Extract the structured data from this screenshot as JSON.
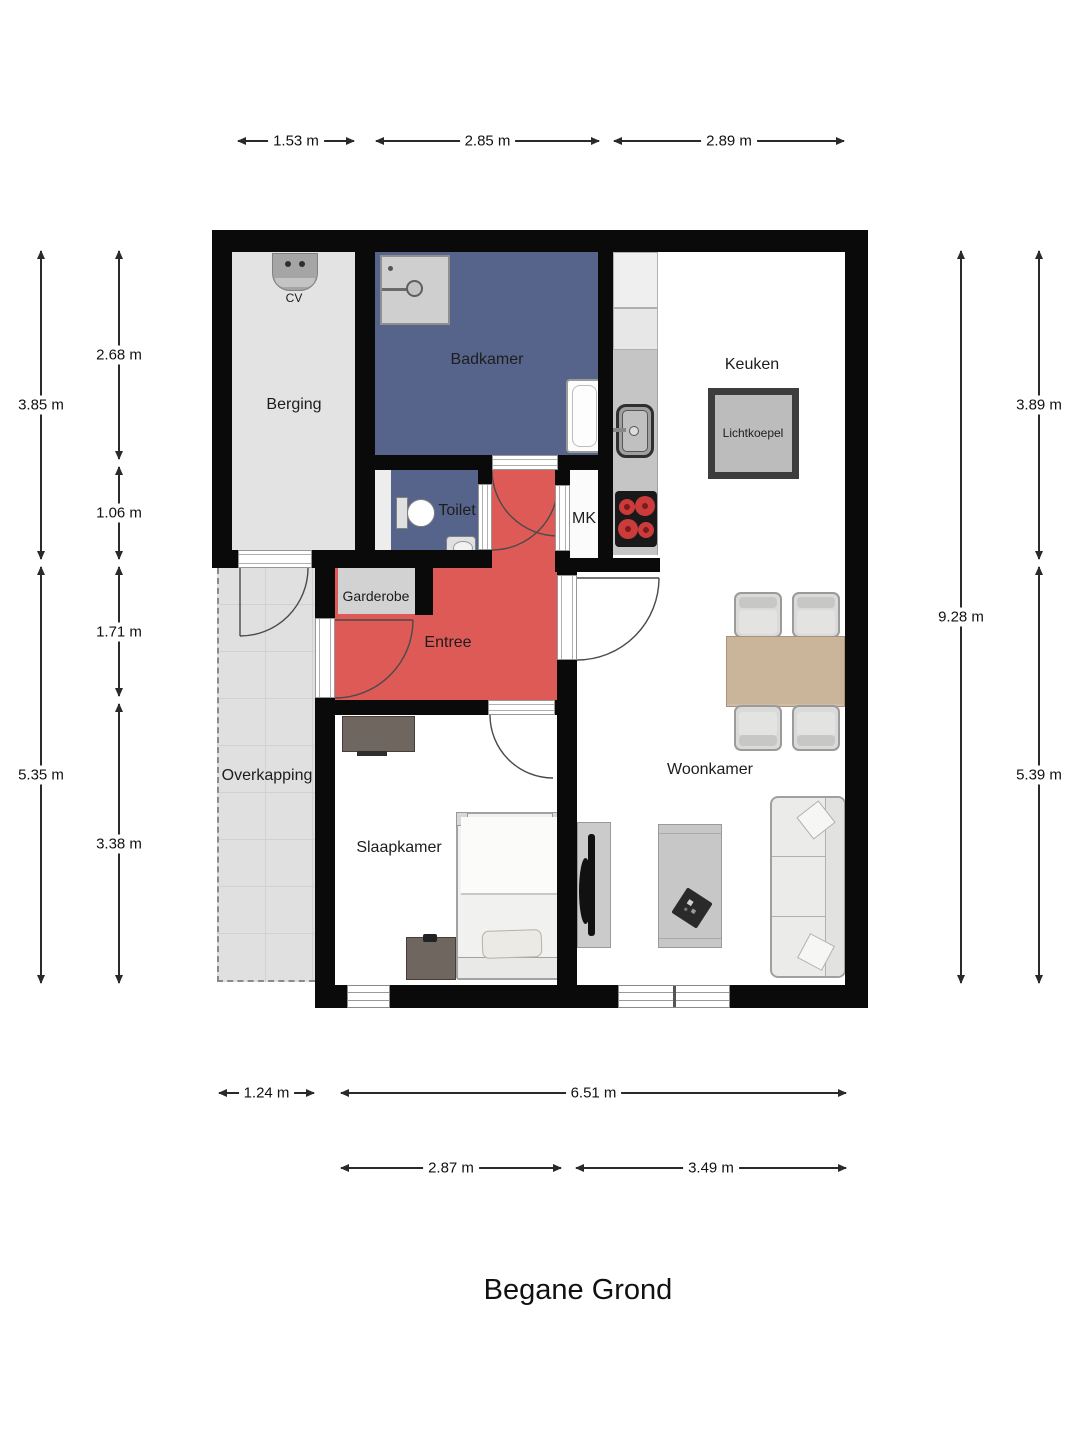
{
  "title": "Begane Grond",
  "rooms": {
    "berging": "Berging",
    "cv": "CV",
    "badkamer": "Badkamer",
    "toilet": "Toilet",
    "mk": "MK",
    "keuken": "Keuken",
    "lichtkoepel": "Lichtkoepel",
    "entree": "Entree",
    "garderobe": "Garderobe",
    "overkapping": "Overkapping",
    "woonkamer": "Woonkamer",
    "slaapkamer": "Slaapkamer"
  },
  "dimensions": {
    "top": [
      "1.53 m",
      "2.85 m",
      "2.89 m"
    ],
    "left_outer": [
      "3.85 m",
      "5.35 m"
    ],
    "left_inner": [
      "2.68 m",
      "1.06 m",
      "1.71 m",
      "3.38 m"
    ],
    "right_inner": [
      "9.28 m"
    ],
    "right_outer": [
      "3.89 m",
      "5.39 m"
    ],
    "bottom_row1": [
      "1.24 m",
      "6.51 m"
    ],
    "bottom_row2": [
      "2.87 m",
      "3.49 m"
    ]
  },
  "colors": {
    "wall": "#0a0a0a",
    "badkamer_fill": "#56648c",
    "entree_fill": "#dd5a57",
    "berging_fill": "#e3e3e3",
    "garderobe_fill": "#d2d2d2",
    "overkapping_fill": "#e0e0e0",
    "kitchen_counter": "#c5c5c5",
    "table_wood": "#cab49a",
    "burner_red": "#cc3b3b"
  }
}
